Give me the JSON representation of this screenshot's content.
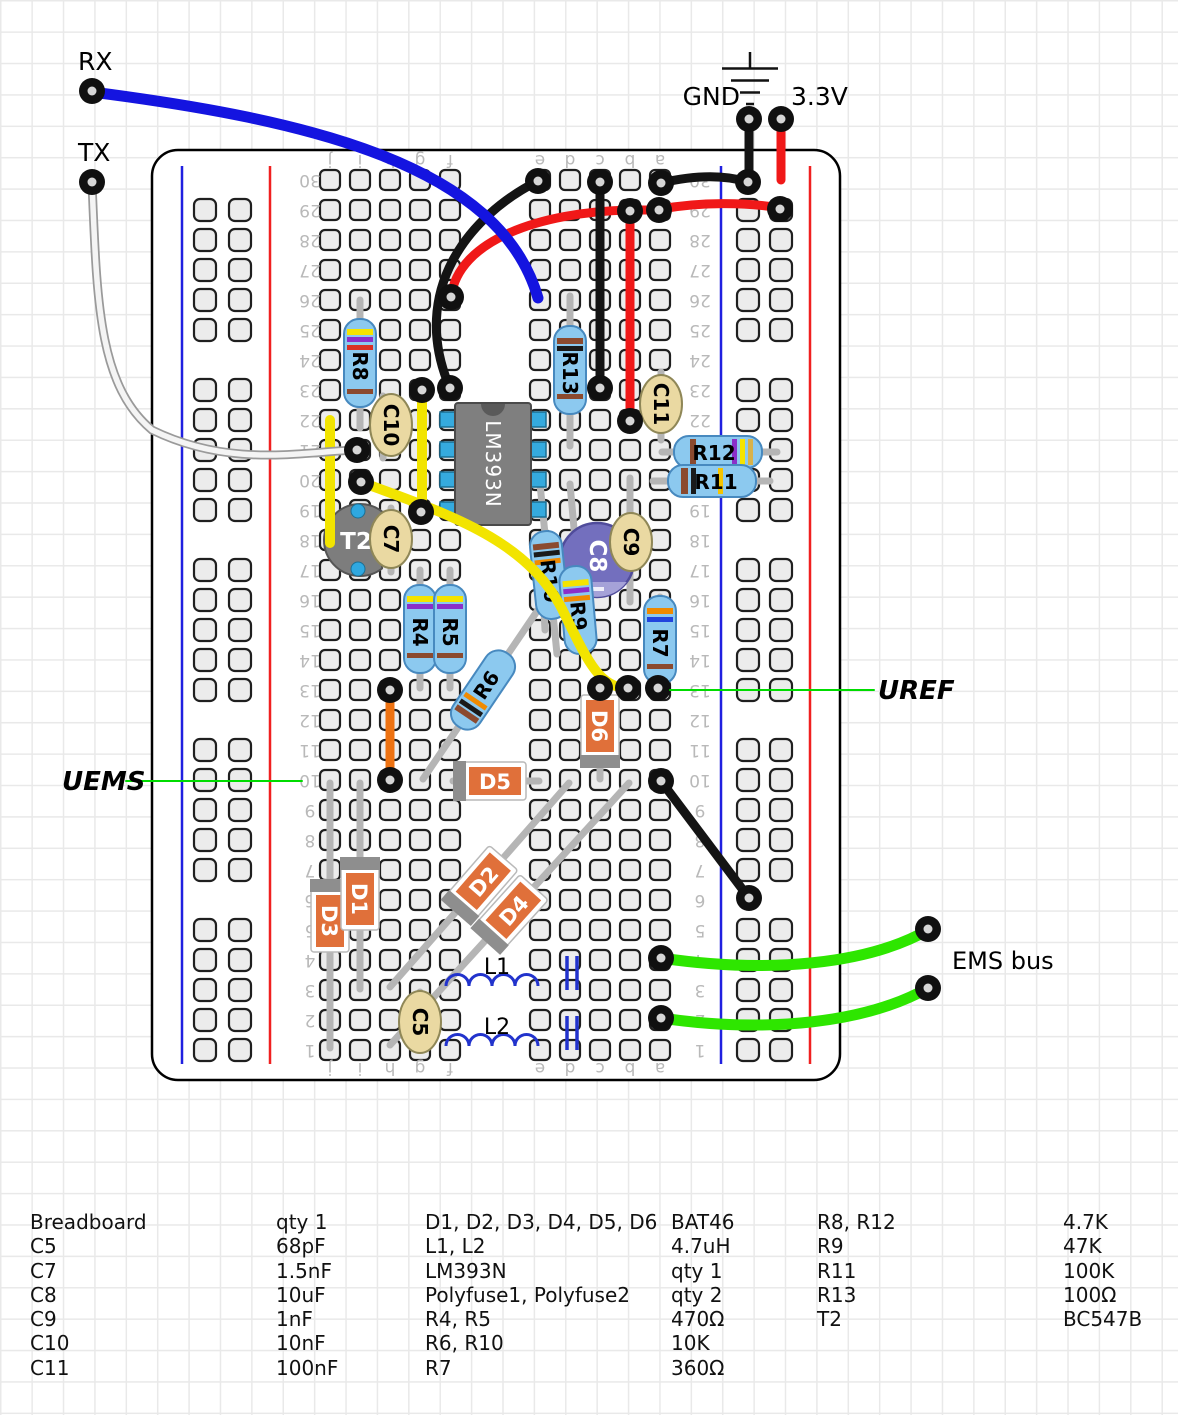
{
  "labels": {
    "rx": "RX",
    "tx": "TX",
    "gnd": "GND",
    "v33": "3.3V",
    "uref": "UREF",
    "uems": "UEMS",
    "ems_bus": "EMS bus"
  },
  "board": {
    "column_letters": [
      "j",
      "i",
      "h",
      "g",
      "f",
      "e",
      "d",
      "c",
      "b",
      "a"
    ],
    "row_numbers": [
      30,
      29,
      28,
      27,
      26,
      25,
      24,
      23,
      22,
      21,
      20,
      19,
      18,
      17,
      16,
      15,
      14,
      13,
      12,
      11,
      10,
      9,
      8,
      7,
      6,
      5,
      4,
      3,
      2,
      1
    ]
  },
  "components": {
    "r4": {
      "label": "R4"
    },
    "r5": {
      "label": "R5"
    },
    "r6": {
      "label": "R6"
    },
    "r7": {
      "label": "R7"
    },
    "r8": {
      "label": "R8"
    },
    "r9": {
      "label": "R9"
    },
    "r10": {
      "label": "R10"
    },
    "r11": {
      "label": "R11"
    },
    "r12": {
      "label": "R12"
    },
    "r13": {
      "label": "R13"
    },
    "c5": {
      "label": "C5"
    },
    "c7": {
      "label": "C7"
    },
    "c8": {
      "label": "C8"
    },
    "c9": {
      "label": "C9"
    },
    "c10": {
      "label": "C10"
    },
    "c11": {
      "label": "C11"
    },
    "d1": {
      "label": "D1"
    },
    "d2": {
      "label": "D2"
    },
    "d3": {
      "label": "D3"
    },
    "d4": {
      "label": "D4"
    },
    "d5": {
      "label": "D5"
    },
    "d6": {
      "label": "D6"
    },
    "l1": {
      "label": "L1"
    },
    "l2": {
      "label": "L2"
    },
    "ic": {
      "label": "LM393N"
    },
    "t2": {
      "label": "T2"
    }
  },
  "colors": {
    "wire_blue": "#1414e0",
    "wire_black": "#141414",
    "wire_red": "#f01818",
    "wire_yellow": "#f2e400",
    "wire_orange": "#ee7211",
    "wire_green": "#2ee600",
    "wire_white": "#f4f4f4",
    "callout_green": "#00dc00",
    "resistor_body": "#8cc9ef",
    "diode_body": "#e0703a",
    "ic_body": "#7f7f7f",
    "pin_blue": "#35aade",
    "cap_disc": "#ead9a2",
    "cap_electrolytic": "#736fbe",
    "board_rail_blue": "#2020e0",
    "board_rail_red": "#f02020"
  },
  "parts_list": {
    "col1": [
      {
        "name": "Breadboard",
        "value": "qty 1"
      },
      {
        "name": "C5",
        "value": "68pF"
      },
      {
        "name": "C7",
        "value": "1.5nF"
      },
      {
        "name": "C8",
        "value": "10uF"
      },
      {
        "name": "C9",
        "value": "1nF"
      },
      {
        "name": "C10",
        "value": "10nF"
      },
      {
        "name": "C11",
        "value": "100nF"
      }
    ],
    "col2": [
      {
        "name": "D1, D2, D3, D4, D5, D6",
        "value": "BAT46"
      },
      {
        "name": "L1, L2",
        "value": "4.7uH"
      },
      {
        "name": "LM393N",
        "value": "qty 1"
      },
      {
        "name": "Polyfuse1, Polyfuse2",
        "value": "qty 2"
      },
      {
        "name": "R4, R5",
        "value": "470Ω"
      },
      {
        "name": "R6, R10",
        "value": "10K"
      },
      {
        "name": "R7",
        "value": "360Ω"
      }
    ],
    "col3": [
      {
        "name": "R8, R12",
        "value": "4.7K"
      },
      {
        "name": "R9",
        "value": "47K"
      },
      {
        "name": "R11",
        "value": "100K"
      },
      {
        "name": "R13",
        "value": "100Ω"
      },
      {
        "name": "T2",
        "value": "BC547B"
      }
    ]
  }
}
